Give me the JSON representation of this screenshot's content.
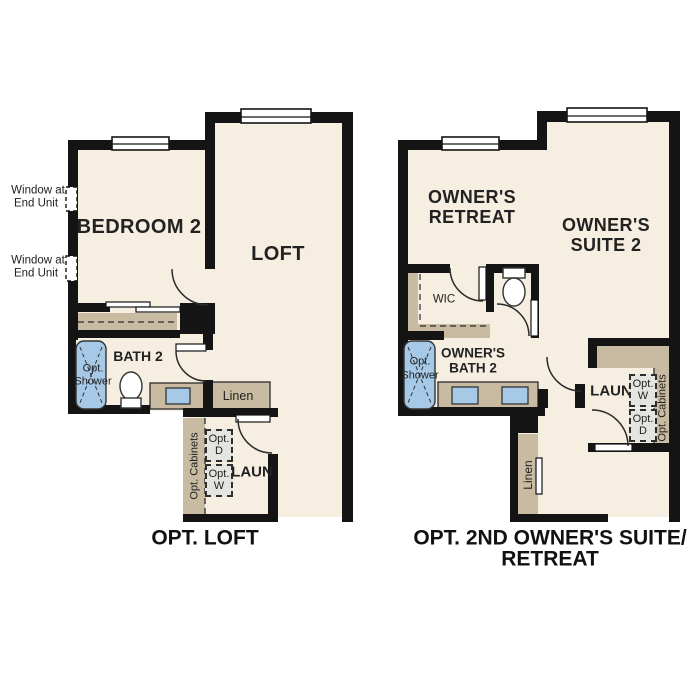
{
  "colors": {
    "wall": "#141414",
    "floor": "#f6eee1",
    "cabinet_tan": "#c8bba1",
    "fixture_blue": "#a7c9e8",
    "appliance_gray": "#e4e4e0",
    "line": "#2b2b2b"
  },
  "plans": {
    "left": {
      "caption": "OPT. LOFT",
      "rooms": {
        "bedroom": "BEDROOM 2",
        "loft": "LOFT",
        "bath": "BATH 2",
        "laundry": "LAUN"
      },
      "labels": {
        "window_note_line1": "Window at",
        "window_note_line2": "End Unit",
        "opt_shower_line1": "Opt.",
        "opt_shower_line2": "Shower",
        "linen": "Linen",
        "opt_cabinets": "Opt. Cabinets",
        "opt_dryer_line1": "Opt.",
        "opt_dryer_line2": "D",
        "opt_washer_line1": "Opt.",
        "opt_washer_line2": "W"
      }
    },
    "right": {
      "caption_line1": "OPT. 2ND OWNER'S SUITE/",
      "caption_line2": "RETREAT",
      "rooms": {
        "retreat_line1": "OWNER'S",
        "retreat_line2": "RETREAT",
        "suite_line1": "OWNER'S",
        "suite_line2": "SUITE 2",
        "bath_line1": "OWNER'S",
        "bath_line2": "BATH 2",
        "wic": "WIC",
        "laundry": "LAUN"
      },
      "labels": {
        "opt_shower_line1": "Opt.",
        "opt_shower_line2": "Shower",
        "linen": "Linen",
        "opt_cabinets": "Opt. Cabinets",
        "opt_washer_line1": "Opt.",
        "opt_washer_line2": "W",
        "opt_dryer_line1": "Opt.",
        "opt_dryer_line2": "D"
      }
    }
  }
}
